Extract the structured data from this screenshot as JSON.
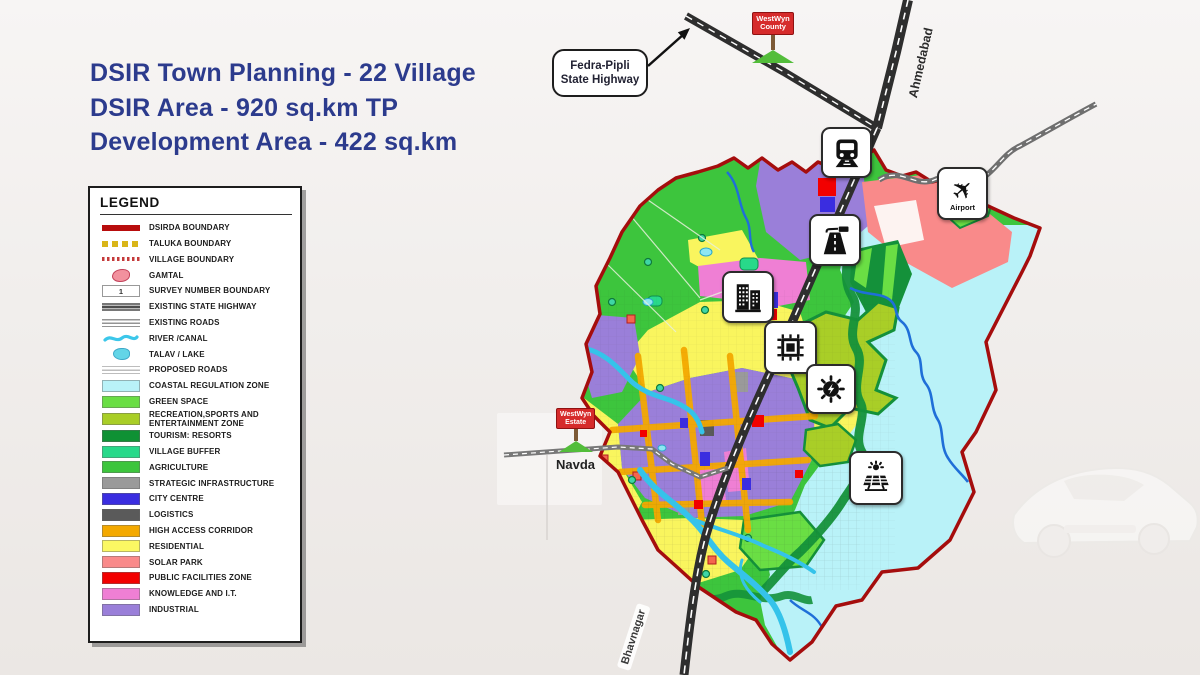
{
  "title": {
    "line1": "DSIR Town Planning - 22 Village",
    "line2": "DSIR Area - 920 sq.km TP",
    "line3": "Development Area - 422 sq.km"
  },
  "legend": {
    "heading": "LEGEND",
    "items": [
      {
        "label": "DSIRDA BOUNDARY",
        "kind": "thickline",
        "color": "#b80d0d"
      },
      {
        "label": "TALUKA BOUNDARY",
        "kind": "dashline",
        "color": "#d9b518"
      },
      {
        "label": "VILLAGE BOUNDARY",
        "kind": "dotline",
        "color": "#c43a3a"
      },
      {
        "label": "GAMTAL",
        "kind": "blob",
        "color": "#f2919e"
      },
      {
        "label": "SURVEY NUMBER BOUNDARY",
        "kind": "numbox",
        "color": "#ffffff",
        "text": "1"
      },
      {
        "label": "EXISTING STATE HIGHWAY",
        "kind": "highway",
        "color": "#4d4d4d"
      },
      {
        "label": "EXISTING ROADS",
        "kind": "roads",
        "color": "#8f8f8f"
      },
      {
        "label": "RIVER /CANAL",
        "kind": "wave",
        "color": "#3cc7ea"
      },
      {
        "label": "TALAV / LAKE",
        "kind": "lake",
        "color": "#63d5e7"
      },
      {
        "label": "PROPOSED ROADS",
        "kind": "proposed",
        "color": "#b5b5b5"
      },
      {
        "label": "COASTAL REGULATION ZONE",
        "kind": "fill",
        "color": "#b9f2f8"
      },
      {
        "label": "GREEN SPACE",
        "kind": "fill",
        "color": "#6ade44"
      },
      {
        "label": "RECREATION,SPORTS AND ENTERTAINMENT ZONE",
        "kind": "fill",
        "color": "#a9ce27"
      },
      {
        "label": "TOURISM: RESORTS",
        "kind": "fill",
        "color": "#0f9134"
      },
      {
        "label": "VILLAGE BUFFER",
        "kind": "fill",
        "color": "#28d98a"
      },
      {
        "label": "AGRICULTURE",
        "kind": "fill",
        "color": "#3dc53d"
      },
      {
        "label": "STRATEGIC INFRASTRUCTURE",
        "kind": "fill",
        "color": "#9a9a9a"
      },
      {
        "label": "CITY CENTRE",
        "kind": "fill",
        "color": "#3a2de0"
      },
      {
        "label": "LOGISTICS",
        "kind": "fill",
        "color": "#5a5a5a"
      },
      {
        "label": "HIGH ACCESS CORRIDOR",
        "kind": "fill",
        "color": "#f4a900"
      },
      {
        "label": "RESIDENTIAL",
        "kind": "fill",
        "color": "#fbf863"
      },
      {
        "label": "SOLAR PARK",
        "kind": "fill",
        "color": "#f98a8a"
      },
      {
        "label": "PUBLIC FACILITIES ZONE",
        "kind": "fill",
        "color": "#f20000"
      },
      {
        "label": "KNOWLEDGE AND I.T.",
        "kind": "fill",
        "color": "#ef7fd4"
      },
      {
        "label": "INDUSTRIAL",
        "kind": "fill",
        "color": "#9a7fd9"
      }
    ]
  },
  "map": {
    "callout": {
      "line1": "Fedra-Pipli",
      "line2": "State Highway"
    },
    "signs": {
      "county": {
        "line1": "WestWyn",
        "line2": "County"
      },
      "estate": {
        "line1": "WestWyn",
        "line2": "Estate"
      }
    },
    "labels": {
      "ahmedabad": "Ahmedabad",
      "bhavnagar": "Bhavnagar",
      "navda": "Navda",
      "airport": "Airport"
    },
    "icons": [
      "train-station",
      "highway",
      "city-centre-buildings",
      "it-chip",
      "energy",
      "solar-farm",
      "airport-plane"
    ]
  },
  "colors": {
    "title_text": "#2c3b8d",
    "dsirda_boundary": "#a50d0d",
    "coastal": "#b9f2f8",
    "green_space": "#6ade44",
    "recreation": "#a9ce27",
    "tourism": "#14913a",
    "village_buffer": "#28d98a",
    "agriculture": "#3dc53d",
    "strategic": "#9a9a9a",
    "city_centre": "#3a2de0",
    "logistics": "#5a5a5a",
    "high_access": "#f4a900",
    "residential": "#f9f55e",
    "solar_park": "#f98a8a",
    "public_facilities": "#f20000",
    "knowledge_it": "#ef7fd4",
    "industrial": "#9a7fd9",
    "river": "#35c3ea",
    "river_deep": "#1f6fd8",
    "road_dark": "#2e2e2e",
    "road_gray": "#6f6f6f"
  }
}
